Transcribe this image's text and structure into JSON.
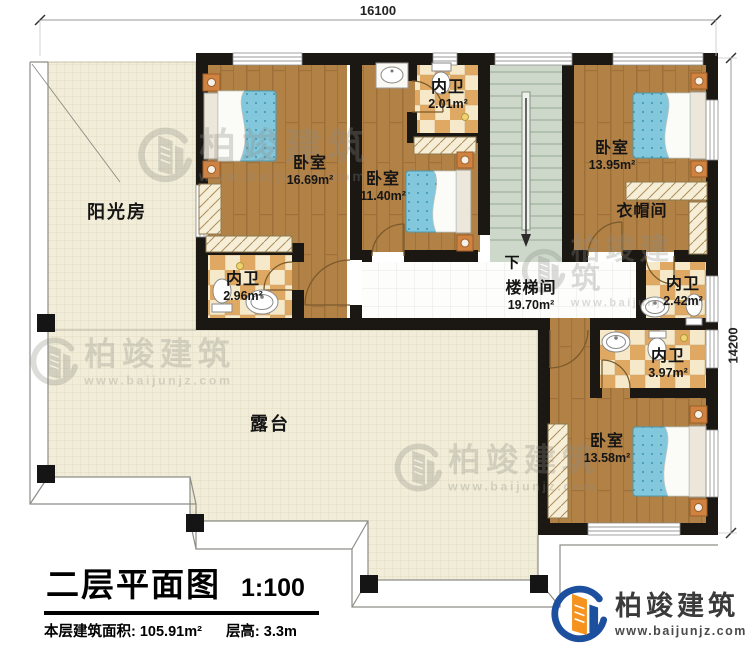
{
  "dimensions": {
    "top": "16100",
    "right": "14200"
  },
  "stair": {
    "direction_label": "下"
  },
  "rooms": [
    {
      "id": "sunroom",
      "name": "阳光房",
      "area": ""
    },
    {
      "id": "bedroom-nw",
      "name": "卧室",
      "area": "16.69m²"
    },
    {
      "id": "bedroom-n",
      "name": "卧室",
      "area": "11.40m²"
    },
    {
      "id": "bath-n",
      "name": "内卫",
      "area": "2.01m²"
    },
    {
      "id": "bedroom-ne",
      "name": "卧室",
      "area": "13.95m²"
    },
    {
      "id": "cloakroom",
      "name": "衣帽间",
      "area": ""
    },
    {
      "id": "bath-w",
      "name": "内卫",
      "area": "2.96m²"
    },
    {
      "id": "stairwell",
      "name": "楼梯间",
      "area": "19.70m²"
    },
    {
      "id": "bath-e",
      "name": "内卫",
      "area": "2.42m²"
    },
    {
      "id": "bath-se",
      "name": "内卫",
      "area": "3.97m²"
    },
    {
      "id": "bedroom-se",
      "name": "卧室",
      "area": "13.58m²"
    },
    {
      "id": "terrace",
      "name": "露台",
      "area": ""
    }
  ],
  "title_block": {
    "title": "二层平面图",
    "scale": "1:100",
    "area_text": "本层建筑面积: 105.91m²",
    "height_text": "层高: 3.3m"
  },
  "brand": {
    "name": "柏竣建筑",
    "url": "www.baijunjz.com"
  },
  "watermark": {
    "name": "柏竣建筑",
    "url": "www.baijunjz.com"
  },
  "colors": {
    "wall": "#1b1713",
    "wood": "#b28146",
    "checker_light": "#f5e9c9",
    "checker_dark": "#dfa963",
    "floor_grid": "#f1edd8",
    "stair_floor": "#cdd8cb",
    "bed_blue": "#82c7dc",
    "nightstand_orange": "#d08240",
    "brand_blue": "#1c4f9e",
    "brand_orange": "#f6921e"
  }
}
